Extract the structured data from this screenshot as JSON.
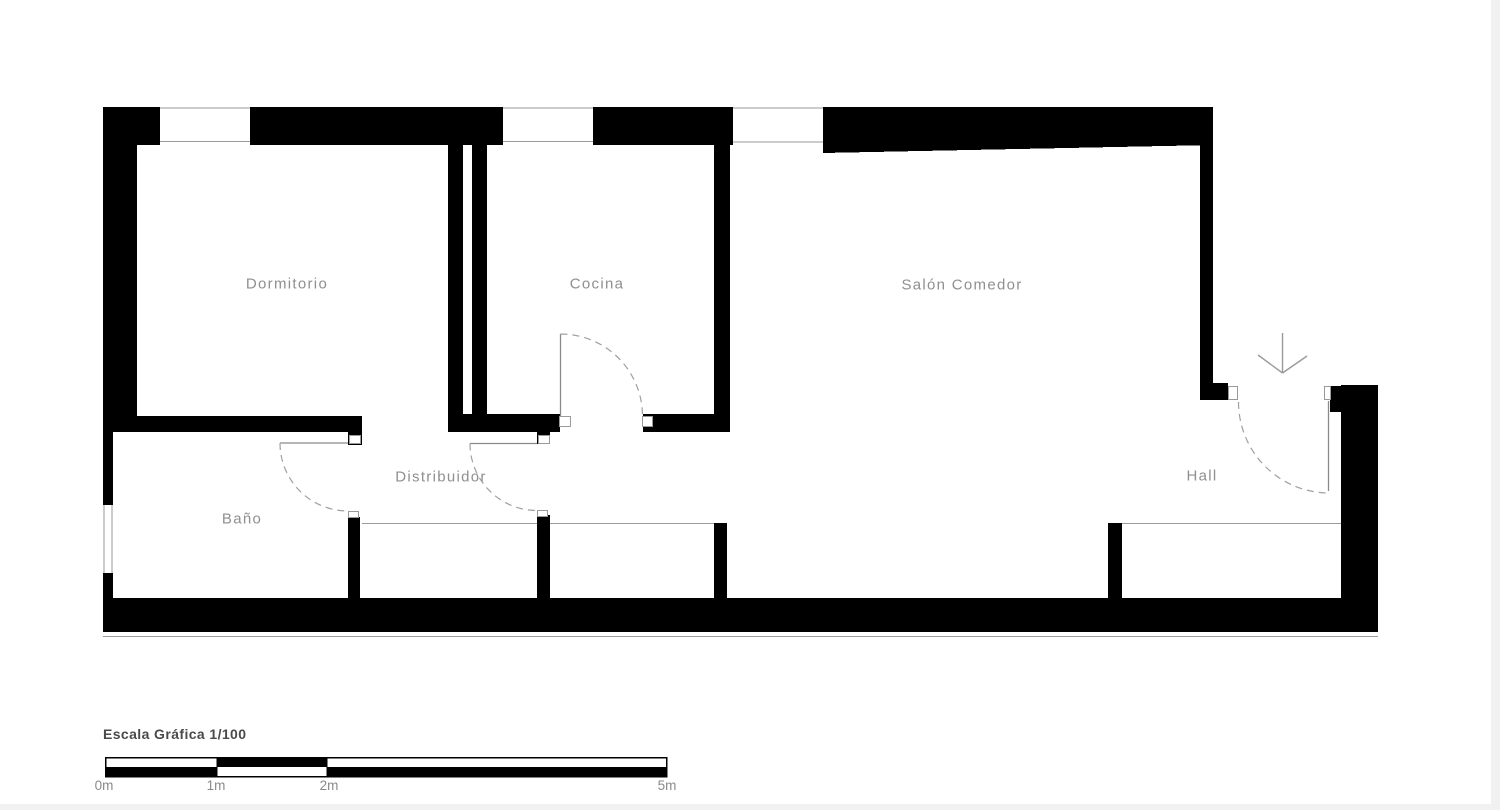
{
  "colors": {
    "wall": "#000000",
    "thin_line": "#9a9a9a",
    "room_label": "#8f8f8f",
    "scale_title_text": "#4a4a4a",
    "background": "#ffffff"
  },
  "rooms": {
    "dormitorio": "Dormitorio",
    "cocina": "Cocina",
    "salon_comedor": "Salón Comedor",
    "distribuidor": "Distribuidor",
    "bano": "Baño",
    "hall": "Hall"
  },
  "scale_bar": {
    "title": "Escala Gráfica 1/100",
    "tick_labels": [
      "0m",
      "1m",
      "2m",
      "5m"
    ]
  },
  "icons": {
    "entrance_arrow": "arrow-down"
  }
}
